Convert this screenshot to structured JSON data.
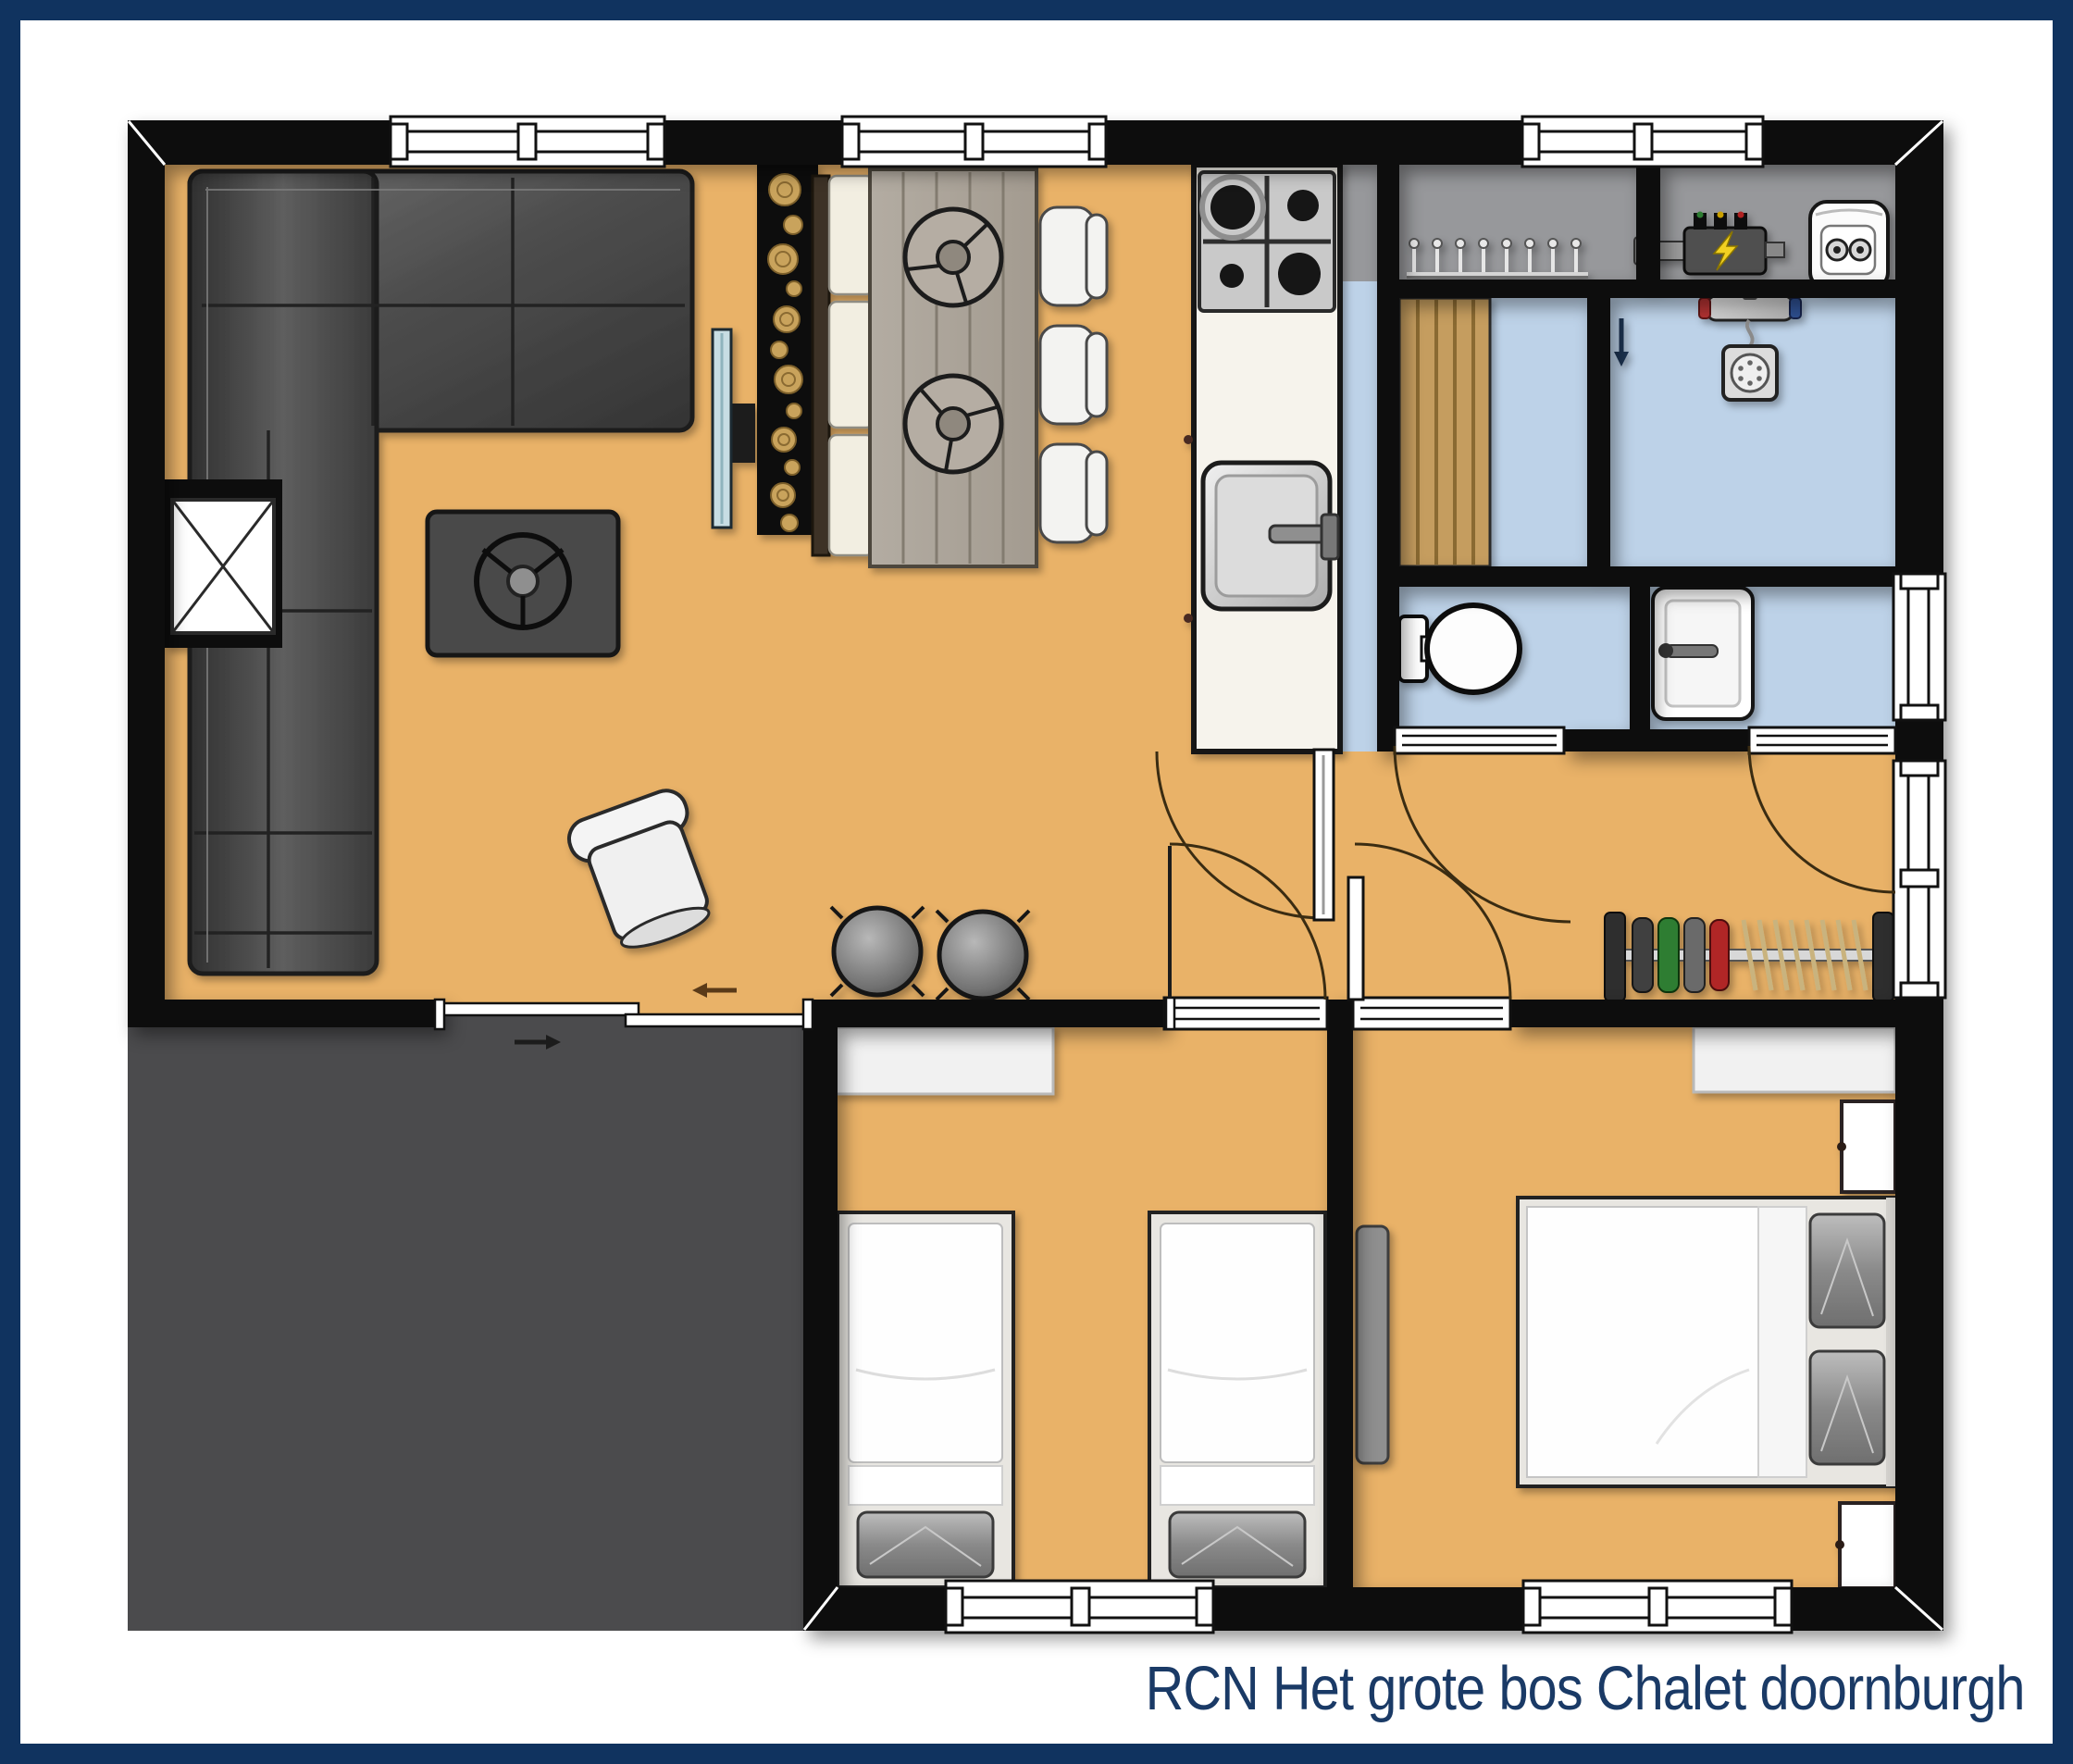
{
  "title": {
    "text": "RCN Het grote bos Chalet doornburgh"
  },
  "palette": {
    "frame_navy": "#10335f",
    "title_navy": "#1a3a66",
    "wall_black": "#0b0b0b",
    "floor_orange": "#e9b268",
    "floor_wet_blue": "#bdd2e8",
    "utility_gray": "#97989b",
    "terrace_gray": "#4b4b4d",
    "wood_slats": "#c59d5e",
    "counter_white": "#f6f3ec",
    "sofa_gray": "#4a4a4a",
    "log_gold": "#c9a35c",
    "hanger_green": "#2e7d32",
    "hanger_red": "#b02525",
    "lightning_yellow": "#f2d020"
  },
  "rooms": [
    {
      "name": "living-room"
    },
    {
      "name": "dining-area"
    },
    {
      "name": "kitchen"
    },
    {
      "name": "utility-room-hooks"
    },
    {
      "name": "utility-room-boiler"
    },
    {
      "name": "storage-room"
    },
    {
      "name": "shower-room"
    },
    {
      "name": "toilet-room"
    },
    {
      "name": "washbasin-room"
    },
    {
      "name": "hallway"
    },
    {
      "name": "bedroom-twin"
    },
    {
      "name": "bedroom-double"
    },
    {
      "name": "terrace"
    }
  ],
  "icons": [
    {
      "name": "corner-sofa"
    },
    {
      "name": "wood-stove-icon"
    },
    {
      "name": "side-table-x-icon"
    },
    {
      "name": "armchair"
    },
    {
      "name": "stool"
    },
    {
      "name": "tv-icon"
    },
    {
      "name": "log-wall-decor"
    },
    {
      "name": "dining-bench"
    },
    {
      "name": "dining-table"
    },
    {
      "name": "dining-chair"
    },
    {
      "name": "gas-hob-icon"
    },
    {
      "name": "kitchen-sink-icon"
    },
    {
      "name": "coat-hooks-icon"
    },
    {
      "name": "electric-meter-icon"
    },
    {
      "name": "boiler-icon"
    },
    {
      "name": "shower-icon"
    },
    {
      "name": "toilet-icon"
    },
    {
      "name": "washbasin-icon"
    },
    {
      "name": "coat-rack-icon"
    },
    {
      "name": "single-bed"
    },
    {
      "name": "double-bed"
    },
    {
      "name": "nightstand"
    },
    {
      "name": "window-symbol"
    },
    {
      "name": "door-swing-symbol"
    },
    {
      "name": "sliding-door-symbol"
    },
    {
      "name": "direction-arrow"
    }
  ]
}
